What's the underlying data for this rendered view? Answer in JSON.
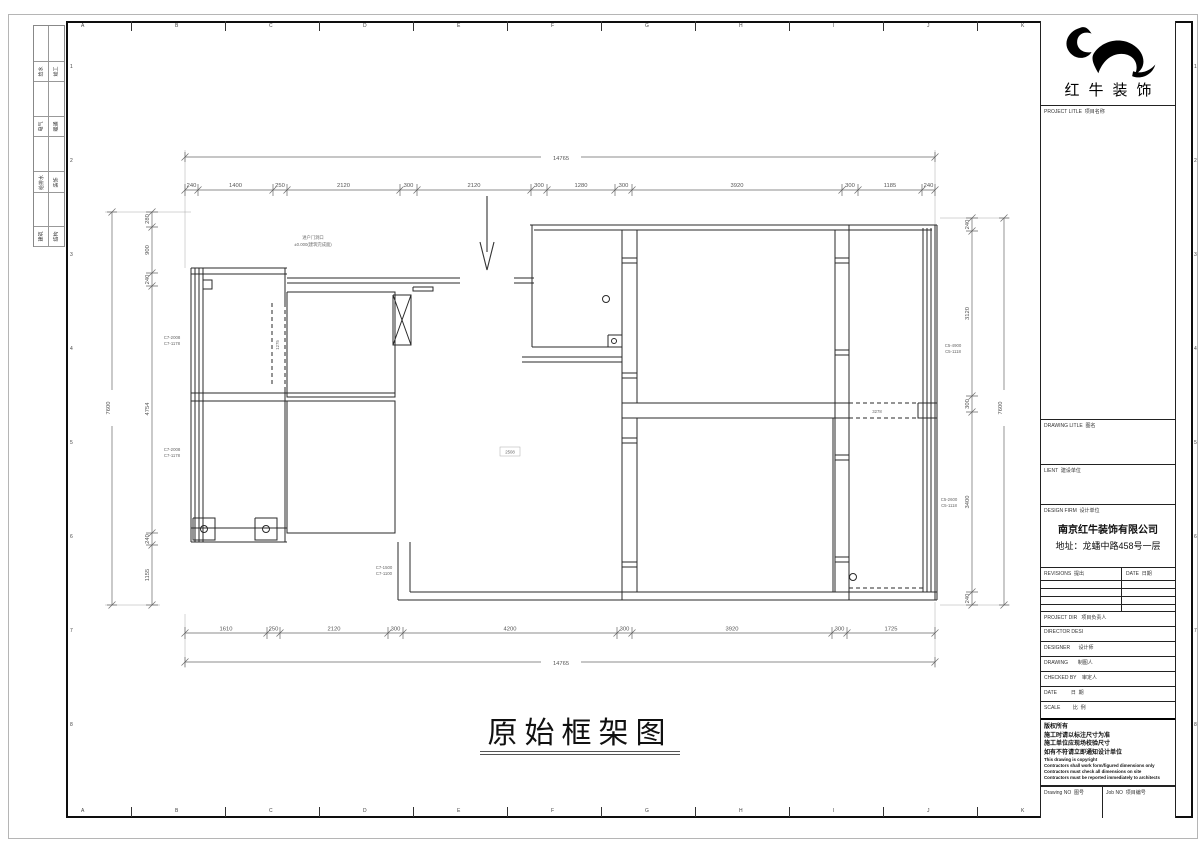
{
  "colors": {
    "line": "#2a2a2a",
    "dim": "#555555",
    "frame": "#0e0e0e",
    "paper": "#ffffff"
  },
  "grid_refs": {
    "letters": [
      "A",
      "B",
      "C",
      "D",
      "E",
      "F",
      "G",
      "H",
      "I",
      "J",
      "K"
    ],
    "numbers": [
      "1",
      "2",
      "3",
      "4",
      "5",
      "6",
      "7",
      "8"
    ]
  },
  "signature_strip": {
    "rows": [
      {
        "left": "给水",
        "right": "竣工"
      },
      {
        "left": "电气",
        "right": "暖通"
      },
      {
        "left": "给排水",
        "right": "装饰"
      },
      {
        "left": "建筑",
        "right": "结构"
      }
    ]
  },
  "title_block": {
    "brand_name": "红牛装饰",
    "project_title_label": "PROJECT LITLE  项目名称",
    "drawing_title_label": "DRAWING LITLE  图名",
    "client_label": "LIENT  建设单位",
    "design_firm_label": "DESIGN FIRM  设计单位",
    "design_firm_name": "南京红牛装饰有限公司",
    "design_firm_address": "地址：龙蟠中路458号一层",
    "revisions_label": "REVISIONS  提出",
    "revisions_date_label": "DATE  日期",
    "project_dir_label": "PROJECT DIR   项目负责人",
    "director_label": "DIRECTOR DESI",
    "designer_label": "DESIGNER      设计师",
    "drawing_by_label": "DRAWING       制图人",
    "checked_by_label": "CHECKED BY    审定人",
    "date_label": "DATE          日  期",
    "scale_label": "SCALE         比  例",
    "copyright_lines_cn": [
      "版权所有",
      "施工时请以标注尺寸为准",
      "施工单位应现场校验尺寸",
      "如有不符请立即通知设计单位"
    ],
    "copyright_lines_en": [
      "This drawing is copyright",
      "Contractors shall work form/figured dimensions only",
      "Contractors must check all dimensions on site",
      "Contractors must be reported immediately to architects"
    ],
    "drawing_no_label": "Drawing NO  图号",
    "job_no_label": "Job NO  项目编号"
  },
  "drawing": {
    "title": "原始框架图",
    "dims": {
      "top_total": "14765",
      "top_chain": [
        "240",
        "1400",
        "250",
        "2120",
        "300",
        "2120",
        "300",
        "1280",
        "300",
        "3920",
        "300",
        "1185",
        "240"
      ],
      "bottom_chain": [
        "1610",
        "250",
        "2120",
        "300",
        "4200",
        "300",
        "3920",
        "300",
        "1725"
      ],
      "bottom_total": "14765",
      "left_chain": [
        "280",
        "900",
        "240",
        "4754",
        "240",
        "1155"
      ],
      "left_total": "7600",
      "right_chain": [
        "240",
        "3120",
        "300",
        "3400",
        "240"
      ],
      "right_total": "7600"
    },
    "annotations": {
      "entry_note_1": "进户门洞口",
      "entry_note_2": "±0.000(建筑完成面)",
      "room_label": "2508",
      "opening_left": "1275",
      "opening_right": "3278",
      "win_code_l1a": "C7-2008",
      "win_code_l1b": "C7-1178",
      "win_code_l2a": "C7-2008",
      "win_code_l2b": "C7-1178",
      "win_code_r1a": "C5-4900",
      "win_code_r1b": "C5-1118",
      "win_code_r2a": "C5-2600",
      "win_code_r2b": "C5-1118",
      "win_code_b1a": "C7-1500",
      "win_code_b1b": "C7-1100"
    }
  }
}
